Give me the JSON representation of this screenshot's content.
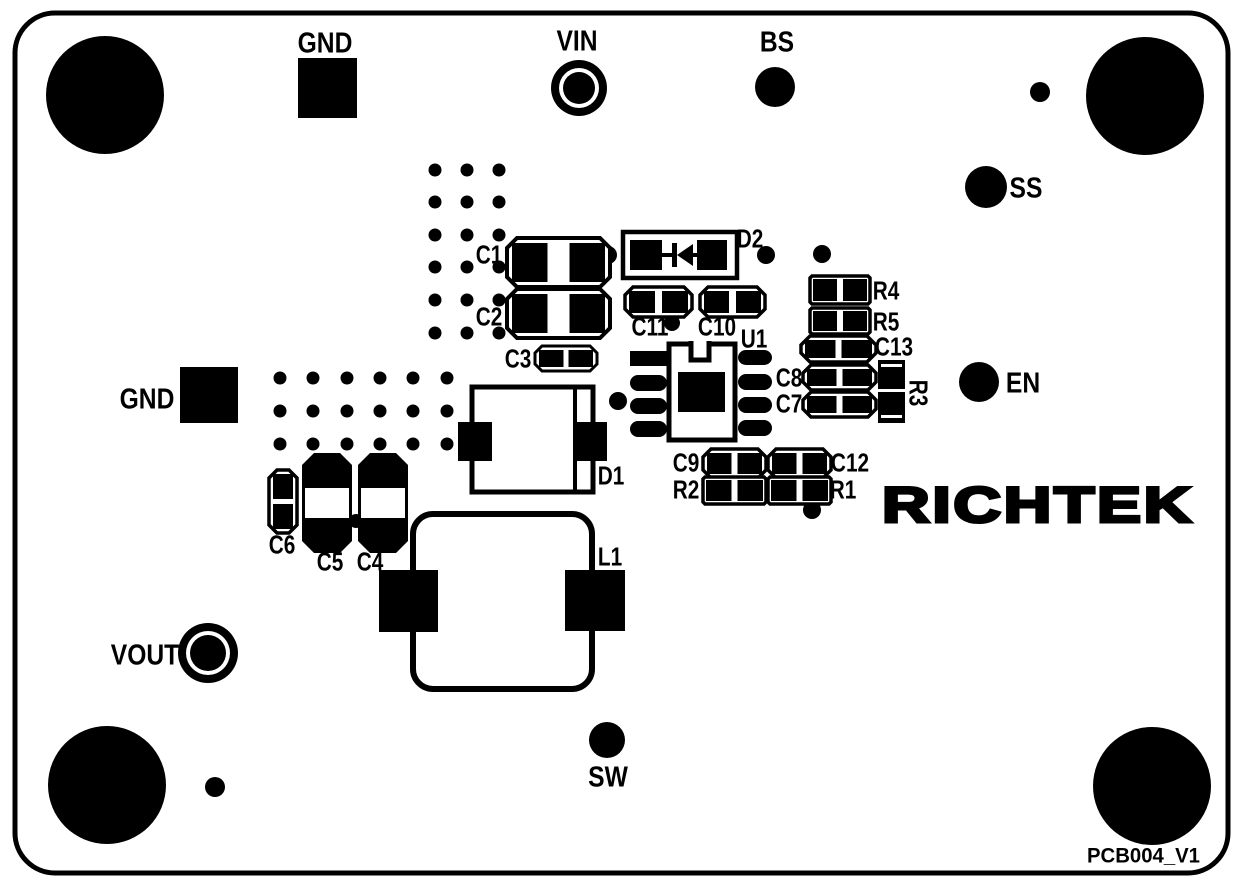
{
  "board": {
    "width": 1244,
    "height": 888,
    "bg": "#ffffff",
    "ink": "#000000",
    "outline": {
      "x": 15,
      "y": 13,
      "w": 1213,
      "h": 860,
      "rx": 40,
      "stroke": 5
    },
    "logo_text": "RICHTEK",
    "logo": {
      "x": 1038,
      "y": 505,
      "size": 50,
      "text_length": 312,
      "stroke": 3
    },
    "version_label": "PCB004_V1",
    "version": {
      "x": 1200,
      "y": 856,
      "size": 21,
      "text_length": 113
    }
  },
  "mounting_holes": [
    {
      "x": 105,
      "y": 95,
      "r": 59
    },
    {
      "x": 1145,
      "y": 96,
      "r": 59
    },
    {
      "x": 107,
      "y": 785,
      "r": 59
    },
    {
      "x": 1152,
      "y": 786,
      "r": 59
    }
  ],
  "small_dots": [
    {
      "x": 1040,
      "y": 92,
      "r": 10
    },
    {
      "x": 215,
      "y": 787,
      "r": 10
    },
    {
      "x": 608,
      "y": 255,
      "r": 9
    },
    {
      "x": 766,
      "y": 255,
      "r": 9
    },
    {
      "x": 822,
      "y": 254,
      "r": 9
    },
    {
      "x": 672,
      "y": 323,
      "r": 8
    },
    {
      "x": 618,
      "y": 401,
      "r": 9
    },
    {
      "x": 812,
      "y": 510,
      "r": 9
    },
    {
      "x": 356,
      "y": 521,
      "r": 7
    }
  ],
  "via_clusters": [
    {
      "cols": [
        435,
        467,
        499
      ],
      "rows": [
        170,
        202,
        235,
        267,
        300,
        333
      ],
      "r": 6.5
    },
    {
      "cols": [
        280,
        313,
        347,
        380,
        413,
        447
      ],
      "rows": [
        378,
        411,
        444
      ],
      "r": 6.5
    }
  ],
  "test_points": [
    {
      "name": "gnd-top",
      "label": "GND",
      "style": "square",
      "x": 298,
      "y": 58,
      "w": 59,
      "h": 60,
      "lx": 325,
      "ly": 42
    },
    {
      "name": "vin",
      "label": "VIN",
      "style": "ring",
      "cx": 579,
      "cy": 88,
      "r_outer": 28,
      "r_white": 20,
      "r_inner": 16,
      "lx": 577,
      "ly": 40
    },
    {
      "name": "bs",
      "label": "BS",
      "style": "dot",
      "cx": 775,
      "cy": 87,
      "r": 20,
      "lx": 777,
      "ly": 41
    },
    {
      "name": "ss",
      "label": "SS",
      "style": "dot",
      "cx": 986,
      "cy": 187,
      "r": 21,
      "lx": 1026,
      "ly": 187
    },
    {
      "name": "gnd-left",
      "label": "GND",
      "style": "square",
      "x": 180,
      "y": 367,
      "w": 58,
      "h": 56,
      "lx": 147,
      "ly": 398
    },
    {
      "name": "en",
      "label": "EN",
      "style": "dot",
      "cx": 979,
      "cy": 382,
      "r": 20,
      "lx": 1023,
      "ly": 382
    },
    {
      "name": "vout",
      "label": "VOUT",
      "style": "ring",
      "cx": 208,
      "cy": 653,
      "r_outer": 30,
      "r_white": 22,
      "r_inner": 18,
      "lx": 145,
      "ly": 654
    },
    {
      "name": "sw",
      "label": "SW",
      "style": "dot",
      "cx": 607,
      "cy": 740,
      "r": 18,
      "lx": 608,
      "ly": 776
    }
  ],
  "components": [
    {
      "ref": "C1",
      "type": "cap_h",
      "x": 507,
      "y": 238,
      "w": 103,
      "h": 49,
      "gap": 22,
      "ch": 10,
      "inset": 5,
      "stroke": 4,
      "lx": 489,
      "ly": 254
    },
    {
      "ref": "C2",
      "type": "cap_h",
      "x": 507,
      "y": 289,
      "w": 103,
      "h": 49,
      "gap": 22,
      "ch": 10,
      "inset": 5,
      "stroke": 4,
      "lx": 489,
      "ly": 316
    },
    {
      "ref": "C3",
      "type": "cap_h",
      "x": 535,
      "y": 346,
      "w": 62,
      "h": 25,
      "gap": 5,
      "ch": 7,
      "inset": 4,
      "stroke": 3,
      "lx": 518,
      "ly": 358
    },
    {
      "ref": "C11",
      "type": "cap_h",
      "x": 625,
      "y": 287,
      "w": 67,
      "h": 30,
      "gap": 7,
      "ch": 8,
      "inset": 4,
      "stroke": 3.5,
      "lx": 650,
      "ly": 326
    },
    {
      "ref": "C10",
      "type": "cap_h",
      "x": 700,
      "y": 287,
      "w": 65,
      "h": 30,
      "gap": 7,
      "ch": 8,
      "inset": 4,
      "stroke": 3.5,
      "lx": 717,
      "ly": 326
    },
    {
      "ref": "D2",
      "type": "diode_sym",
      "x": 623,
      "y": 232,
      "w": 114,
      "h": 46,
      "stroke": 4.5,
      "pads": [
        [
          630,
          240,
          32,
          30
        ],
        [
          697,
          240,
          30,
          30
        ]
      ],
      "bar": [
        672,
        243,
        5,
        24
      ],
      "tri": [
        [
          677,
          255
        ],
        [
          693,
          244
        ],
        [
          693,
          266
        ]
      ],
      "line_y": 255,
      "lines": [
        [
          662,
          672
        ],
        [
          693,
          700
        ]
      ],
      "lx": 750,
      "ly": 238
    },
    {
      "ref": "U1",
      "type": "ic8",
      "outline": [
        669,
        344,
        66,
        96
      ],
      "notch": [
        691,
        341,
        18,
        19
      ],
      "square": [
        678,
        372,
        47,
        40
      ],
      "stroke": 5,
      "pads": [
        [
          630,
          351,
          37,
          15,
          0
        ],
        [
          630,
          375,
          37,
          16,
          8
        ],
        [
          630,
          398,
          37,
          16,
          8
        ],
        [
          630,
          421,
          37,
          16,
          8
        ],
        [
          738,
          350,
          34,
          15,
          8
        ],
        [
          738,
          374,
          34,
          16,
          8
        ],
        [
          738,
          397,
          34,
          16,
          8
        ],
        [
          738,
          420,
          34,
          16,
          8
        ]
      ],
      "lx": 754,
      "ly": 338
    },
    {
      "ref": "R4",
      "type": "cap_h",
      "x": 810,
      "y": 276,
      "w": 60,
      "h": 28,
      "gap": 6,
      "ch": 2,
      "inset": 3,
      "stroke": 3.5,
      "lx": 886,
      "ly": 290
    },
    {
      "ref": "R5",
      "type": "cap_h",
      "x": 810,
      "y": 308,
      "w": 60,
      "h": 26,
      "gap": 6,
      "ch": 2,
      "inset": 3,
      "stroke": 3.5,
      "lx": 886,
      "ly": 321
    },
    {
      "ref": "C13",
      "type": "cap_h",
      "x": 801,
      "y": 336,
      "w": 75,
      "h": 26,
      "gap": 6,
      "ch": 9,
      "inset": 4,
      "stroke": 3.5,
      "lx": 894,
      "ly": 346
    },
    {
      "ref": "C8",
      "type": "cap_h",
      "x": 803,
      "y": 365,
      "w": 73,
      "h": 25,
      "gap": 6,
      "ch": 8,
      "inset": 4,
      "stroke": 3.5,
      "lx": 789,
      "ly": 377
    },
    {
      "ref": "C7",
      "type": "cap_h",
      "x": 803,
      "y": 392,
      "w": 73,
      "h": 25,
      "gap": 6,
      "ch": 8,
      "inset": 4,
      "stroke": 3.5,
      "lx": 789,
      "ly": 403
    },
    {
      "ref": "R3",
      "type": "res_v",
      "x": 878,
      "y": 360,
      "w": 27,
      "h": 63,
      "lx": 919,
      "ly": 393,
      "rotate": 90
    },
    {
      "ref": "C9",
      "type": "cap_h",
      "x": 703,
      "y": 449,
      "w": 63,
      "h": 29,
      "gap": 6,
      "ch": 8,
      "inset": 4,
      "stroke": 3.5,
      "lx": 686,
      "ly": 462
    },
    {
      "ref": "C12",
      "type": "cap_h",
      "x": 768,
      "y": 449,
      "w": 63,
      "h": 29,
      "gap": 6,
      "ch": 8,
      "inset": 4,
      "stroke": 3.5,
      "lx": 850,
      "ly": 462
    },
    {
      "ref": "R2",
      "type": "cap_h",
      "x": 703,
      "y": 477,
      "w": 63,
      "h": 27,
      "gap": 6,
      "ch": 2,
      "inset": 3,
      "stroke": 3.5,
      "lx": 686,
      "ly": 489
    },
    {
      "ref": "R1",
      "type": "cap_h",
      "x": 768,
      "y": 477,
      "w": 63,
      "h": 27,
      "gap": 6,
      "ch": 2,
      "inset": 3,
      "stroke": 3.5,
      "lx": 843,
      "ly": 489
    },
    {
      "ref": "D1",
      "type": "diode_big",
      "x": 472,
      "y": 387,
      "w": 121,
      "h": 105,
      "band_x": 575,
      "stroke": 5,
      "pads": [
        [
          458,
          422,
          34,
          39
        ],
        [
          573,
          422,
          34,
          39
        ]
      ],
      "lx": 611,
      "ly": 475
    },
    {
      "ref": "L1",
      "type": "inductor",
      "x": 413,
      "y": 514,
      "w": 179,
      "h": 175,
      "rx": 20,
      "stroke": 6,
      "pads": [
        [
          379,
          570,
          59,
          62
        ],
        [
          565,
          570,
          60,
          61
        ]
      ],
      "lx": 610,
      "ly": 556
    },
    {
      "ref": "C6",
      "type": "cap_v_sm",
      "x": 269,
      "y": 470,
      "w": 28,
      "h": 63,
      "gap": 5,
      "stroke": 3.5,
      "lx": 282,
      "ly": 544
    },
    {
      "ref": "C5",
      "type": "cap_v",
      "x": 302,
      "y": 453,
      "w": 50,
      "h": 100,
      "band": [
        488,
        30
      ],
      "lx": 330,
      "ly": 561
    },
    {
      "ref": "C4",
      "type": "cap_v",
      "x": 358,
      "y": 453,
      "w": 50,
      "h": 100,
      "band": [
        488,
        30
      ],
      "lx": 370,
      "ly": 561
    }
  ],
  "fonts": {
    "pin_size": 29,
    "pin_scale_x": 0.85,
    "ref_size": 26,
    "ref_scale_x": 0.8
  }
}
